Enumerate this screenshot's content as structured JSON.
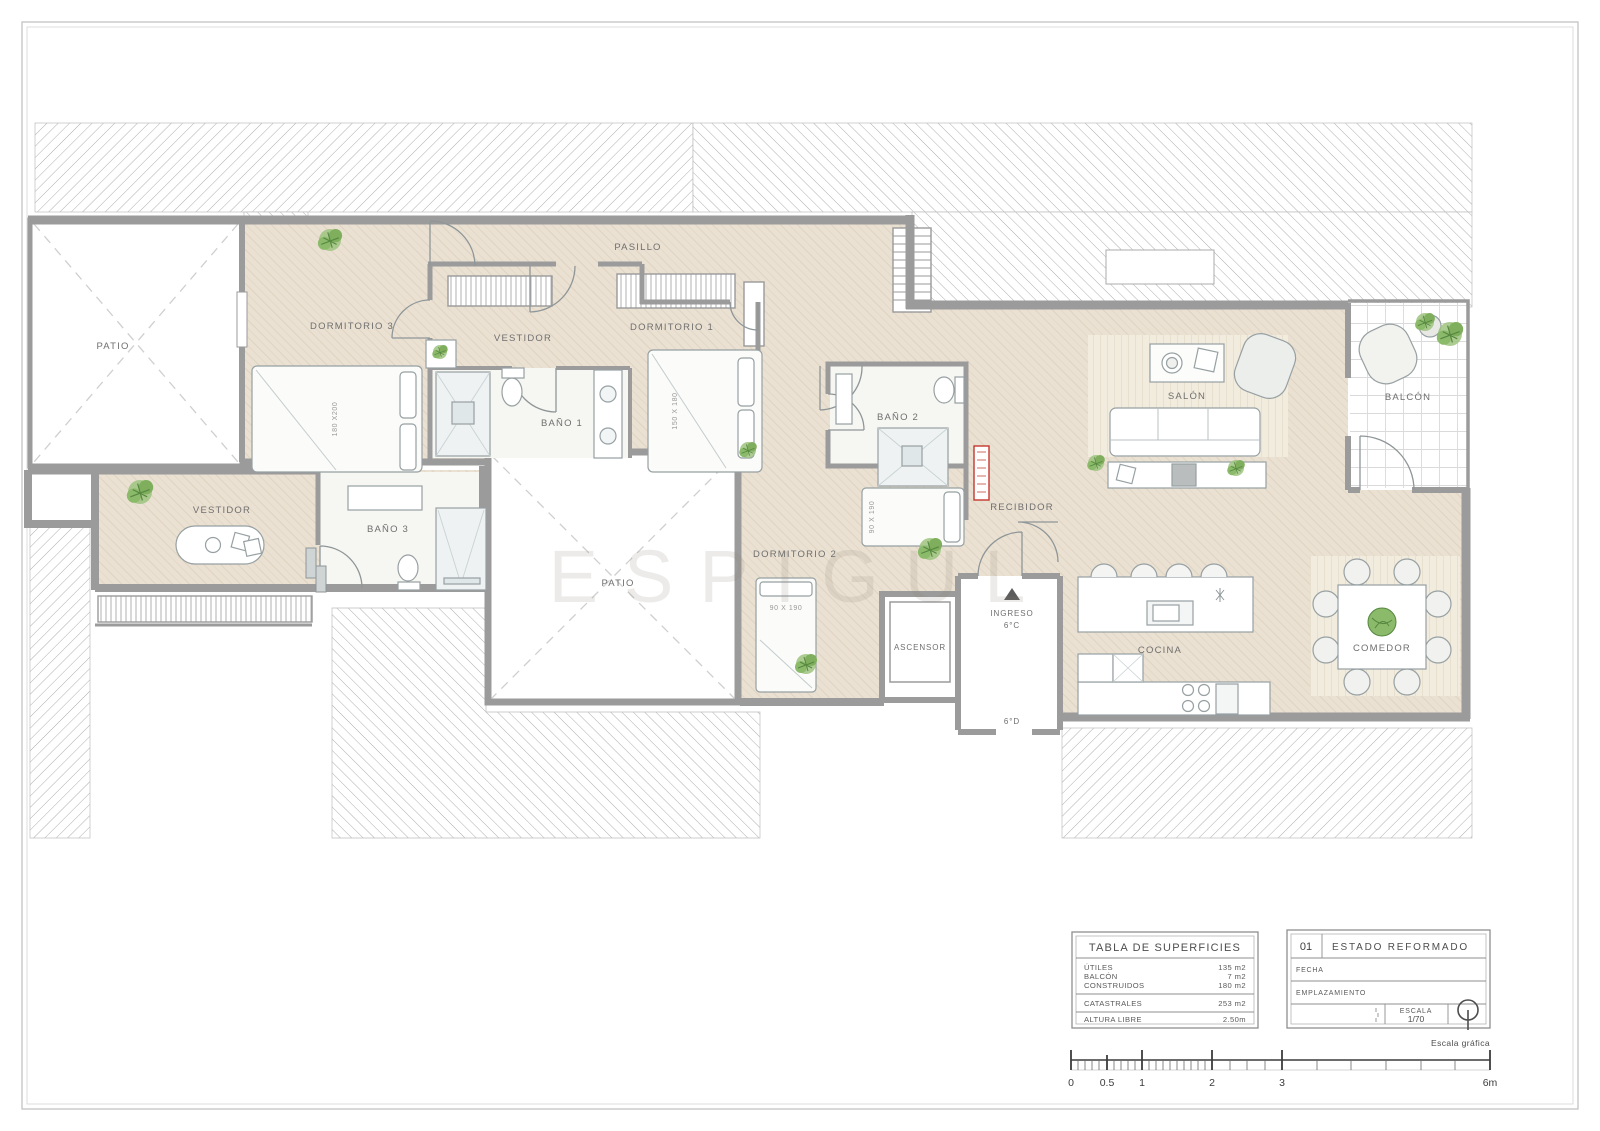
{
  "plan": {
    "rooms": {
      "patio_left": "PATIO",
      "dormitorio3": "DORMITORIO 3",
      "vestidor_top": "VESTIDOR",
      "pasillo": "PASILLO",
      "dormitorio1": "DORMITORIO 1",
      "bano1": "BAÑO 1",
      "bano2": "BAÑO 2",
      "dormitorio2": "DORMITORIO 2",
      "vestidor_left": "VESTIDOR",
      "bano3": "BAÑO 3",
      "patio_center": "PATIO",
      "recibidor": "RECIBIDOR",
      "ascensor": "ASCENSOR",
      "ingreso": "INGRESO",
      "salon": "SALÓN",
      "balcon": "BALCÓN",
      "cocina": "COCINA",
      "comedor": "COMEDOR"
    },
    "door_codes": {
      "entry": "6°C",
      "exit": "6°D"
    },
    "bed_sizes": {
      "dormitorio3": "180 X200",
      "dormitorio1": "150 X 180",
      "dormitorio2_a": "90 X 190",
      "dormitorio2_b": "90 X 190"
    },
    "watermark": "ESPIGUL"
  },
  "surface_table": {
    "title": "TABLA DE SUPERFICIES",
    "rows": [
      {
        "label": "ÚTILES",
        "value": "135 m2"
      },
      {
        "label": "BALCÓN",
        "value": "7 m2"
      },
      {
        "label": "CONSTRUIDOS",
        "value": "180 m2"
      },
      {
        "label": "CATASTRALES",
        "value": "253 m2"
      },
      {
        "label": "ALTURA LIBRE",
        "value": "2.50m"
      }
    ]
  },
  "title_block": {
    "sheet_number": "01",
    "sheet_title": "ESTADO REFORMADO",
    "fecha_label": "FECHA",
    "emplazamiento_label": "EMPLAZAMIENTO",
    "escala_label": "ESCALA",
    "escala_value": "1/70"
  },
  "scale_bar": {
    "caption": "Escala gráfica",
    "labels": [
      "0",
      "0.5",
      "1",
      "2",
      "3",
      "6m"
    ]
  },
  "colors": {
    "floor": "#EAE1D3",
    "wall": "#9B9B9B",
    "radiator_red": "#C4372E",
    "plant_green": "#7FAF5D"
  }
}
